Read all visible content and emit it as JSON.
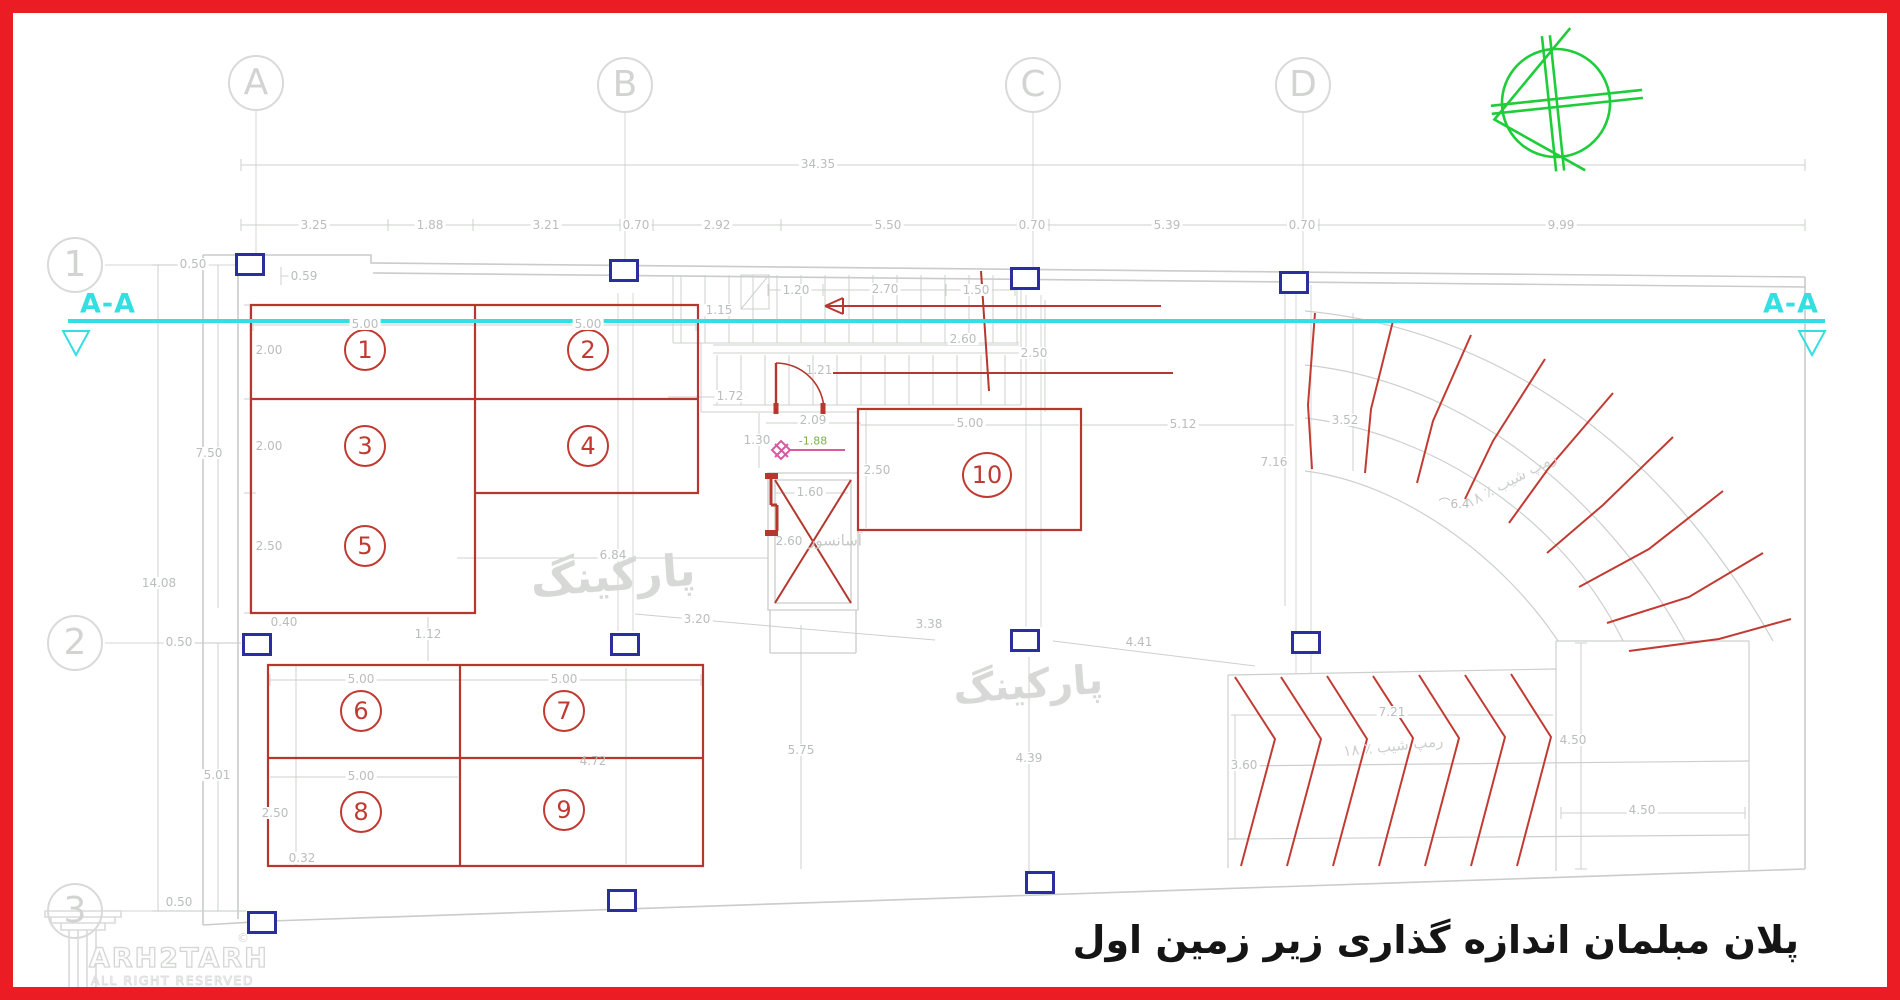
{
  "title": {
    "text": "پلان مبلمان اندازه گذاری زیر زمین اول"
  },
  "logo": {
    "brand": "ARH2TARH",
    "reg": "©",
    "sub": "ALL RIGHT RESERVED"
  },
  "axes": {
    "cols": [
      "A",
      "B",
      "C",
      "D"
    ],
    "rows": [
      "1",
      "2",
      "3"
    ]
  },
  "section": {
    "left": "A-A",
    "right": "A-A"
  },
  "watermarks": {
    "parking1": "پارکینگ",
    "parking2": "پارکینگ"
  },
  "rooms": {
    "elevator": "آسانسور",
    "ramp_note_upper": "رمپ شیب ٪ ١٨",
    "ramp_note_lower": "رمپ شیب ٪ ١٨",
    "radius_label": "⌒6.4"
  },
  "spaces": [
    "1",
    "2",
    "3",
    "4",
    "5",
    "6",
    "7",
    "8",
    "9",
    "10"
  ],
  "level_marker": "-1.88",
  "dims": {
    "total_top": "34.35",
    "top_row": [
      "3.25",
      "1.88",
      "3.21",
      "0.70",
      "2.92",
      "5.50",
      "0.70",
      "5.39",
      "0.70",
      "9.99"
    ],
    "left": {
      "w050a": "0.50",
      "w059": "0.59",
      "h750": "7.50",
      "h1408": "14.08",
      "w050b": "0.50",
      "h501": "5.01",
      "w050c": "0.50"
    },
    "upper_block": {
      "w500a": "5.00",
      "w500b": "5.00",
      "h200a": "2.00",
      "h200b": "2.00",
      "h250": "2.50",
      "w040": "0.40",
      "w684": "6.84"
    },
    "stairs": {
      "w115": "1.15",
      "w120": "1.20",
      "w270": "2.70",
      "w150": "1.50",
      "w260": "2.60",
      "h250": "2.50",
      "w172": "1.72",
      "w121": "1.21",
      "w209": "2.09",
      "h130": "1.30"
    },
    "elevator": {
      "w160": "1.60",
      "h260": "2.60"
    },
    "space10": {
      "w500": "5.00",
      "h250": "2.50",
      "w512": "5.12",
      "h716": "7.16"
    },
    "lower_block": {
      "w112": "1.12",
      "w320": "3.20",
      "w500a": "5.00",
      "w500b": "5.00",
      "w500c": "5.00",
      "h250": "2.50",
      "h032": "0.32",
      "h472": "4.72"
    },
    "bottom": {
      "w338": "3.38",
      "w441": "4.41",
      "h575": "5.75",
      "h439": "4.39"
    },
    "ramp": {
      "h352": "3.52",
      "w721": "7.21",
      "h360": "3.60",
      "h450": "4.50",
      "w450": "4.50"
    }
  },
  "colors": {
    "frame_red": "#ec1c24",
    "plan_red": "#b5372e",
    "hatch_red": "#c23b33",
    "column_blue": "#2b2f9e",
    "section_cyan": "#35dee1",
    "compass_green": "#1fcc3a",
    "dim_gray": "#b9bdbb",
    "line_gray": "#c9ccca",
    "marker_magenta": "#d65ba0",
    "level_green": "#7ab24a"
  }
}
